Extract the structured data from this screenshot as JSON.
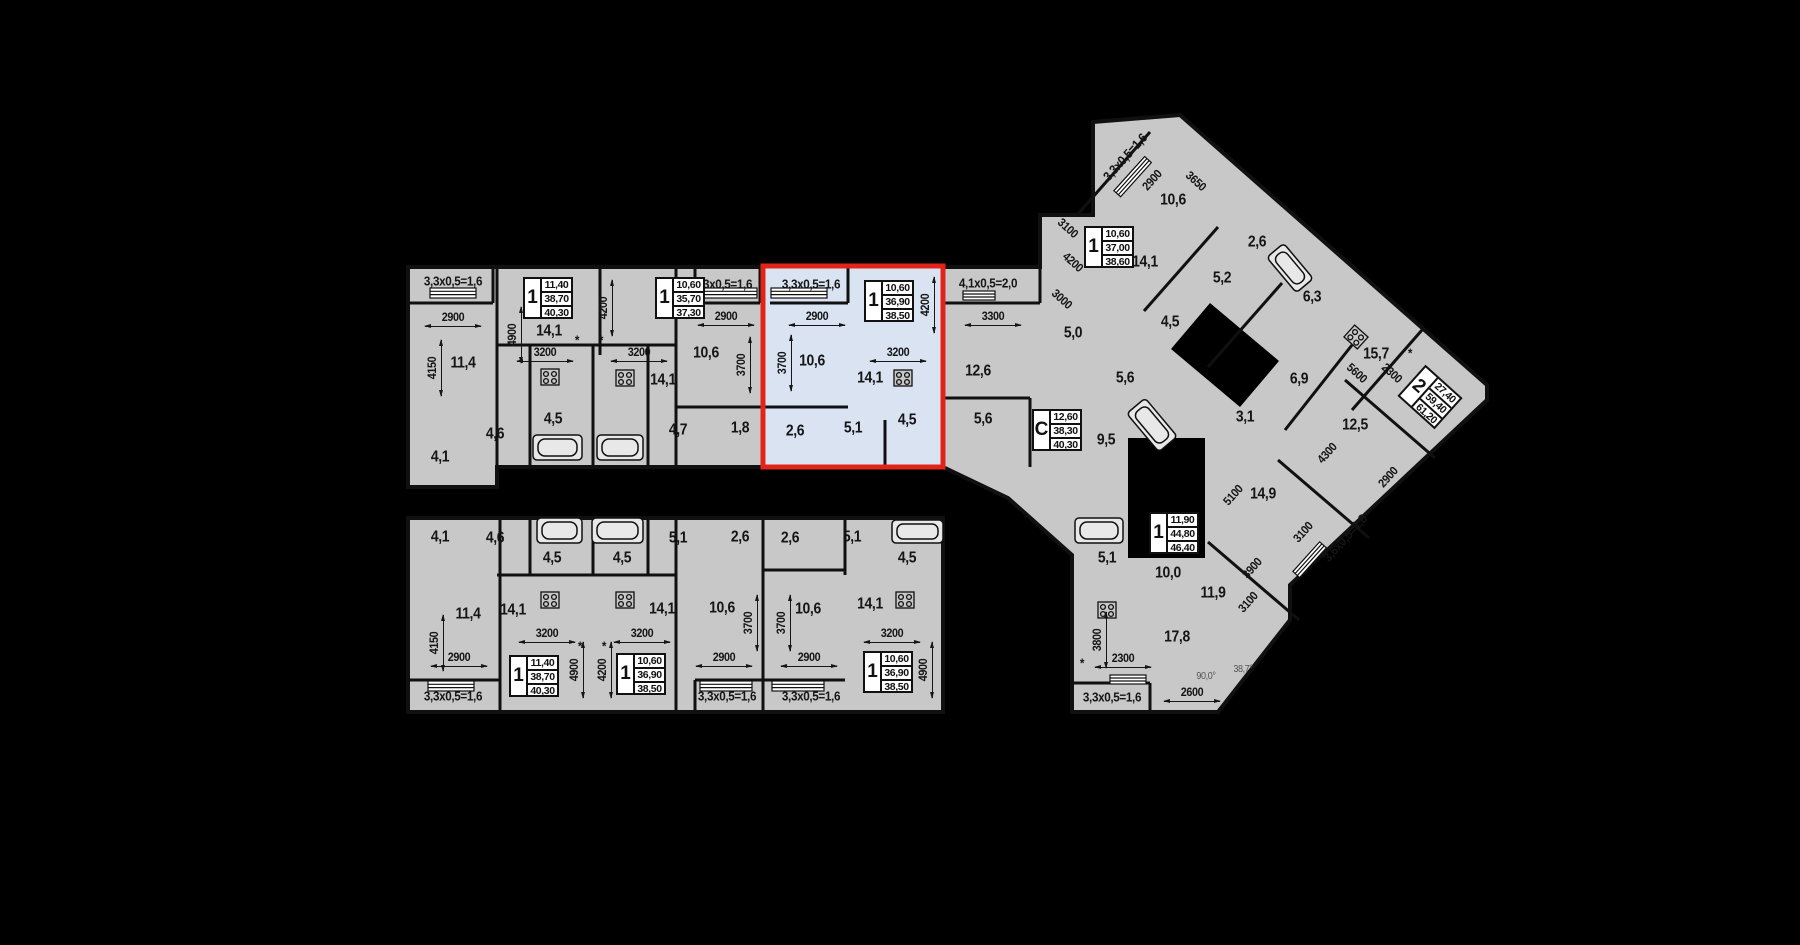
{
  "colors": {
    "background": "#000000",
    "floor": "#c8c8c8",
    "wall": "#101010",
    "highlight_fill": "#d9e3f2",
    "highlight_border": "#e2231a",
    "stat_box_bg": "#ffffff",
    "text": "#151515",
    "angle_text": "#555555"
  },
  "selected_apartment": {
    "rooms": "1",
    "living_area": "10,60",
    "apartment_area": "36,90",
    "total_area": "38,50"
  },
  "stat_boxes": [
    {
      "x": 548,
      "y": 298,
      "rooms": "1",
      "living": "11,40",
      "area": "38,70",
      "total": "40,30"
    },
    {
      "x": 680,
      "y": 298,
      "rooms": "1",
      "living": "10,60",
      "area": "35,70",
      "total": "37,30"
    },
    {
      "x": 889,
      "y": 301,
      "rooms": "1",
      "living": "10,60",
      "area": "36,90",
      "total": "38,50",
      "hl": true
    },
    {
      "x": 1057,
      "y": 430,
      "rooms": "С",
      "living": "12,60",
      "area": "38,30",
      "total": "40,30"
    },
    {
      "x": 1109,
      "y": 247,
      "rooms": "1",
      "living": "10,60",
      "area": "37,00",
      "total": "38,60"
    },
    {
      "x": 1430,
      "y": 397,
      "r": 42,
      "rooms": "2",
      "living": "27,40",
      "area": "59,40",
      "total": "61,20"
    },
    {
      "x": 1174,
      "y": 533,
      "rooms": "1",
      "living": "11,90",
      "area": "44,80",
      "total": "46,40"
    },
    {
      "x": 534,
      "y": 676,
      "rooms": "1",
      "living": "11,40",
      "area": "38,70",
      "total": "40,30"
    },
    {
      "x": 641,
      "y": 674,
      "rooms": "1",
      "living": "10,60",
      "area": "36,90",
      "total": "38,50"
    },
    {
      "x": 888,
      "y": 672,
      "rooms": "1",
      "living": "10,60",
      "area": "36,90",
      "total": "38,50"
    }
  ],
  "labels": [
    {
      "t": "3,3х0,5=1,6",
      "x": 453,
      "y": 281,
      "k": "balcony"
    },
    {
      "t": "2900",
      "x": 453,
      "y": 317,
      "k": "dim",
      "d": "h"
    },
    {
      "t": "4150",
      "x": 432,
      "y": 368,
      "k": "dim",
      "r": -90,
      "d": "v"
    },
    {
      "t": "11,4",
      "x": 463,
      "y": 363,
      "k": "area"
    },
    {
      "t": "4900",
      "x": 512,
      "y": 335,
      "k": "dim",
      "r": -90,
      "d": "v"
    },
    {
      "t": "14,1",
      "x": 549,
      "y": 331,
      "k": "area"
    },
    {
      "t": "3200",
      "x": 545,
      "y": 352,
      "k": "dim",
      "d": "h"
    },
    {
      "t": "4,5",
      "x": 553,
      "y": 419,
      "k": "area"
    },
    {
      "t": "4,6",
      "x": 495,
      "y": 434,
      "k": "area"
    },
    {
      "t": "4,1",
      "x": 440,
      "y": 457,
      "k": "area"
    },
    {
      "t": "4200",
      "x": 603,
      "y": 308,
      "k": "dim",
      "r": -90,
      "d": "v"
    },
    {
      "t": "3200",
      "x": 639,
      "y": 352,
      "k": "dim",
      "d": "h"
    },
    {
      "t": "14,1",
      "x": 663,
      "y": 380,
      "k": "area"
    },
    {
      "t": "4,7",
      "x": 678,
      "y": 430,
      "k": "area"
    },
    {
      "t": "3,3х0,5=1,6",
      "x": 723,
      "y": 284,
      "k": "balcony"
    },
    {
      "t": "2900",
      "x": 726,
      "y": 316,
      "k": "dim",
      "d": "h"
    },
    {
      "t": "10,6",
      "x": 706,
      "y": 353,
      "k": "area"
    },
    {
      "t": "3700",
      "x": 741,
      "y": 365,
      "k": "dim",
      "r": -90,
      "d": "v"
    },
    {
      "t": "1,8",
      "x": 740,
      "y": 428,
      "k": "area"
    },
    {
      "t": "3,3х0,5=1,6",
      "x": 811,
      "y": 284,
      "k": "balcony"
    },
    {
      "t": "2900",
      "x": 817,
      "y": 316,
      "k": "dim",
      "d": "h"
    },
    {
      "t": "3700",
      "x": 782,
      "y": 363,
      "k": "dim",
      "r": -90,
      "d": "v"
    },
    {
      "t": "10,6",
      "x": 812,
      "y": 361,
      "k": "area"
    },
    {
      "t": "4200",
      "x": 925,
      "y": 305,
      "k": "dim",
      "r": -90,
      "d": "v"
    },
    {
      "t": "3200",
      "x": 898,
      "y": 352,
      "k": "dim",
      "d": "h"
    },
    {
      "t": "14,1",
      "x": 870,
      "y": 378,
      "k": "area"
    },
    {
      "t": "2,6",
      "x": 795,
      "y": 431,
      "k": "area"
    },
    {
      "t": "5,1",
      "x": 853,
      "y": 428,
      "k": "area"
    },
    {
      "t": "4,5",
      "x": 907,
      "y": 420,
      "k": "area"
    },
    {
      "t": "4,1х0,5=2,0",
      "x": 988,
      "y": 283,
      "k": "balcony"
    },
    {
      "t": "3300",
      "x": 993,
      "y": 316,
      "k": "dim",
      "d": "h"
    },
    {
      "t": "12,6",
      "x": 978,
      "y": 371,
      "k": "area"
    },
    {
      "t": "5,6",
      "x": 983,
      "y": 419,
      "k": "area"
    },
    {
      "t": "9,5",
      "x": 1106,
      "y": 440,
      "k": "area"
    },
    {
      "t": "5,0",
      "x": 1073,
      "y": 333,
      "k": "area"
    },
    {
      "t": "3000",
      "x": 1062,
      "y": 299,
      "k": "dim",
      "r": 42
    },
    {
      "t": "4200",
      "x": 1073,
      "y": 262,
      "k": "dim",
      "r": 42
    },
    {
      "t": "3100",
      "x": 1068,
      "y": 228,
      "k": "dim",
      "r": 42
    },
    {
      "t": "3,3х0,5=1,6",
      "x": 1125,
      "y": 157,
      "k": "balcony",
      "r": -48
    },
    {
      "t": "2900",
      "x": 1152,
      "y": 180,
      "k": "dim",
      "r": -48
    },
    {
      "t": "3650",
      "x": 1196,
      "y": 181,
      "k": "dim",
      "r": 42
    },
    {
      "t": "10,6",
      "x": 1173,
      "y": 200,
      "k": "area"
    },
    {
      "t": "14,1",
      "x": 1145,
      "y": 262,
      "k": "area"
    },
    {
      "t": "2,6",
      "x": 1257,
      "y": 242,
      "k": "area"
    },
    {
      "t": "5,2",
      "x": 1222,
      "y": 278,
      "k": "area"
    },
    {
      "t": "4,5",
      "x": 1170,
      "y": 322,
      "k": "area"
    },
    {
      "t": "5,6",
      "x": 1125,
      "y": 378,
      "k": "area"
    },
    {
      "t": "6,3",
      "x": 1312,
      "y": 297,
      "k": "area"
    },
    {
      "t": "15,7",
      "x": 1376,
      "y": 354,
      "k": "area"
    },
    {
      "t": "5600",
      "x": 1357,
      "y": 373,
      "k": "dim",
      "r": 42
    },
    {
      "t": "2300",
      "x": 1392,
      "y": 373,
      "k": "dim",
      "r": 42
    },
    {
      "t": "6,9",
      "x": 1299,
      "y": 379,
      "k": "area"
    },
    {
      "t": "3,1",
      "x": 1245,
      "y": 417,
      "k": "area"
    },
    {
      "t": "12,5",
      "x": 1355,
      "y": 425,
      "k": "area"
    },
    {
      "t": "4300",
      "x": 1327,
      "y": 453,
      "k": "dim",
      "r": -48
    },
    {
      "t": "2900",
      "x": 1388,
      "y": 477,
      "k": "dim",
      "r": -48
    },
    {
      "t": "14,9",
      "x": 1263,
      "y": 494,
      "k": "area"
    },
    {
      "t": "5100",
      "x": 1233,
      "y": 495,
      "k": "dim",
      "r": -48
    },
    {
      "t": "3100",
      "x": 1303,
      "y": 532,
      "k": "dim",
      "r": -48
    },
    {
      "t": "3,6х0,5=1,8",
      "x": 1345,
      "y": 538,
      "k": "balcony",
      "r": -48
    },
    {
      "t": "10,0",
      "x": 1168,
      "y": 573,
      "k": "area"
    },
    {
      "t": "11,9",
      "x": 1213,
      "y": 593,
      "k": "area"
    },
    {
      "t": "3900",
      "x": 1252,
      "y": 568,
      "k": "dim",
      "r": -48
    },
    {
      "t": "3100",
      "x": 1248,
      "y": 602,
      "k": "dim",
      "r": -48
    },
    {
      "t": "5,1",
      "x": 1107,
      "y": 558,
      "k": "area"
    },
    {
      "t": "17,8",
      "x": 1177,
      "y": 637,
      "k": "area"
    },
    {
      "t": "3800",
      "x": 1097,
      "y": 640,
      "k": "dim",
      "r": -90,
      "d": "v"
    },
    {
      "t": "2300",
      "x": 1123,
      "y": 658,
      "k": "dim",
      "d": "h"
    },
    {
      "t": "3,3х0,5=1,6",
      "x": 1112,
      "y": 697,
      "k": "balcony"
    },
    {
      "t": "2600",
      "x": 1192,
      "y": 692,
      "k": "dim",
      "d": "h"
    },
    {
      "t": "90,0°",
      "x": 1206,
      "y": 677,
      "k": "angle"
    },
    {
      "t": "38,7°",
      "x": 1243,
      "y": 670,
      "k": "angle"
    },
    {
      "t": "4,1",
      "x": 440,
      "y": 537,
      "k": "area"
    },
    {
      "t": "4,6",
      "x": 495,
      "y": 538,
      "k": "area"
    },
    {
      "t": "4,5",
      "x": 552,
      "y": 558,
      "k": "area"
    },
    {
      "t": "4,5",
      "x": 622,
      "y": 558,
      "k": "area"
    },
    {
      "t": "5,1",
      "x": 678,
      "y": 538,
      "k": "area"
    },
    {
      "t": "2,6",
      "x": 740,
      "y": 537,
      "k": "area"
    },
    {
      "t": "2,6",
      "x": 790,
      "y": 538,
      "k": "area"
    },
    {
      "t": "5,1",
      "x": 852,
      "y": 537,
      "k": "area"
    },
    {
      "t": "4,5",
      "x": 907,
      "y": 558,
      "k": "area"
    },
    {
      "t": "11,4",
      "x": 468,
      "y": 614,
      "k": "area"
    },
    {
      "t": "14,1",
      "x": 513,
      "y": 610,
      "k": "area"
    },
    {
      "t": "14,1",
      "x": 662,
      "y": 609,
      "k": "area"
    },
    {
      "t": "10,6",
      "x": 722,
      "y": 608,
      "k": "area"
    },
    {
      "t": "10,6",
      "x": 808,
      "y": 609,
      "k": "area"
    },
    {
      "t": "14,1",
      "x": 870,
      "y": 604,
      "k": "area"
    },
    {
      "t": "4150",
      "x": 434,
      "y": 643,
      "k": "dim",
      "r": -90,
      "d": "v"
    },
    {
      "t": "2900",
      "x": 459,
      "y": 657,
      "k": "dim",
      "d": "h"
    },
    {
      "t": "3200",
      "x": 547,
      "y": 633,
      "k": "dim",
      "d": "h"
    },
    {
      "t": "3200",
      "x": 642,
      "y": 633,
      "k": "dim",
      "d": "h"
    },
    {
      "t": "2900",
      "x": 724,
      "y": 657,
      "k": "dim",
      "d": "h"
    },
    {
      "t": "2900",
      "x": 809,
      "y": 657,
      "k": "dim",
      "d": "h"
    },
    {
      "t": "3200",
      "x": 892,
      "y": 633,
      "k": "dim",
      "d": "h"
    },
    {
      "t": "3700",
      "x": 748,
      "y": 623,
      "k": "dim",
      "r": -90,
      "d": "v"
    },
    {
      "t": "3700",
      "x": 781,
      "y": 623,
      "k": "dim",
      "r": -90,
      "d": "v"
    },
    {
      "t": "4900",
      "x": 574,
      "y": 670,
      "k": "dim",
      "r": -90,
      "d": "v"
    },
    {
      "t": "4200",
      "x": 602,
      "y": 670,
      "k": "dim",
      "r": -90,
      "d": "v"
    },
    {
      "t": "4900",
      "x": 923,
      "y": 670,
      "k": "dim",
      "r": -90,
      "d": "v"
    },
    {
      "t": "3,3х0,5=1,6",
      "x": 453,
      "y": 696,
      "k": "balcony"
    },
    {
      "t": "3,3х0,5=1,6",
      "x": 727,
      "y": 696,
      "k": "balcony"
    },
    {
      "t": "3,3х0,5=1,6",
      "x": 811,
      "y": 696,
      "k": "balcony"
    },
    {
      "t": "*",
      "x": 577,
      "y": 340,
      "k": "star"
    },
    {
      "t": "*",
      "x": 601,
      "y": 340,
      "k": "star"
    },
    {
      "t": "*",
      "x": 1410,
      "y": 353,
      "k": "star"
    },
    {
      "t": "*",
      "x": 1082,
      "y": 663,
      "k": "star"
    },
    {
      "t": "*",
      "x": 580,
      "y": 646,
      "k": "star"
    },
    {
      "t": "*",
      "x": 604,
      "y": 646,
      "k": "star"
    }
  ]
}
